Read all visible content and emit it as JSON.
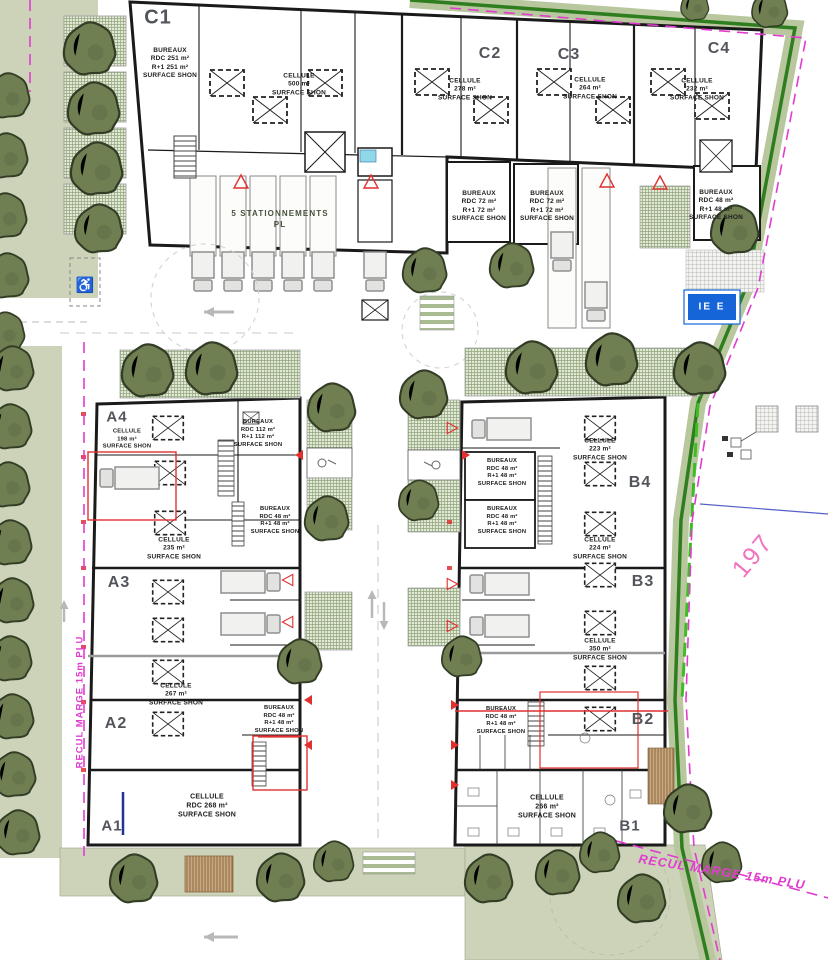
{
  "site": {
    "parking_label": [
      "5 STATIONNEMENTS",
      "PL"
    ],
    "margin_left": "RECUL MARGE 15m PLU",
    "margin_bottom": "RECUL MARGE 15m PLU",
    "parcel_number": "197",
    "sign_text": "IE E"
  },
  "units": {
    "c1": {
      "name": "C1",
      "bureaux": [
        "BUREAUX",
        "RDC 251 m²",
        "R+1 251 m²",
        "SURFACE SHON"
      ],
      "cellule": [
        "CELLULE",
        "500 m²",
        "SURFACE SHON"
      ]
    },
    "c2": {
      "name": "C2",
      "cellule": [
        "CELLULE",
        "278 m²",
        "SURFACE SHON"
      ],
      "bureaux": [
        "BUREAUX",
        "RDC 72 m²",
        "R+1 72 m²",
        "SURFACE SHON"
      ]
    },
    "c3": {
      "name": "C3",
      "cellule": [
        "CELLULE",
        "264 m²",
        "SURFACE SHON"
      ],
      "bureaux": [
        "BUREAUX",
        "RDC 72 m²",
        "R+1 72 m²",
        "SURFACE SHON"
      ]
    },
    "c4": {
      "name": "C4",
      "cellule": [
        "CELLULE",
        "232 m²",
        "SURFACE SHON"
      ],
      "bureaux": [
        "BUREAUX",
        "RDC 48 m²",
        "R+1 48 m²",
        "SURFACE SHON"
      ]
    },
    "a4": {
      "name": "A4",
      "cellule": [
        "CELLULE",
        "198 m²",
        "SURFACE SHON"
      ],
      "bureaux": [
        "BUREAUX",
        "RDC 112 m²",
        "R+1 112 m²",
        "SURFACE SHON"
      ],
      "bureaux48": [
        "BUREAUX",
        "RDC 48 m²",
        "R+1 48 m²",
        "SURFACE SHON"
      ],
      "cellule2": [
        "CELLULE",
        "235 m²",
        "SURFACE SHON"
      ]
    },
    "a3": {
      "name": "A3",
      "cellule": [
        "CELLULE",
        "267 m²",
        "SURFACE SHON"
      ]
    },
    "a2": {
      "name": "A2",
      "bureaux": [
        "BUREAUX",
        "RDC 48 m²",
        "R+1 48 m²",
        "SURFACE SHON"
      ],
      "cellule": [
        "CELLULE",
        "RDC 268 m²",
        "SURFACE SHON"
      ]
    },
    "a1": {
      "name": "A1"
    },
    "b4": {
      "name": "B4",
      "cellule": [
        "CELLULE",
        "223 m²",
        "SURFACE SHON"
      ],
      "bureaux_top": [
        "BUREAUX",
        "RDC 48 m²",
        "R+1 48 m²",
        "SURFACE SHON"
      ],
      "bureaux_bottom": [
        "BUREAUX",
        "RDC 48 m²",
        "R+1 48 m²",
        "SURFACE SHON"
      ]
    },
    "b3": {
      "name": "B3",
      "cellule": [
        "CELLULE",
        "224 m²",
        "SURFACE SHON"
      ],
      "cellule2": [
        "CELLULE",
        "350 m²",
        "SURFACE SHON"
      ]
    },
    "b2": {
      "name": "B2",
      "bureaux": [
        "BUREAUX",
        "RDC 48 m²",
        "R+1 48 m²",
        "SURFACE SHON"
      ],
      "cellule": [
        "CELLULE",
        "266 m²",
        "SURFACE SHON"
      ]
    },
    "b1": {
      "name": "B1"
    }
  },
  "colors": {
    "margin_magenta": "#e23bd0",
    "parcel_pink": "#f273be",
    "band_green": "#b8c79d",
    "boundary_green": "#2e7d1e",
    "tree_green": "#6f7f52",
    "landscape_green": "#ccd3b8",
    "sign_blue": "#1565d8",
    "marker_red": "#e03030"
  }
}
